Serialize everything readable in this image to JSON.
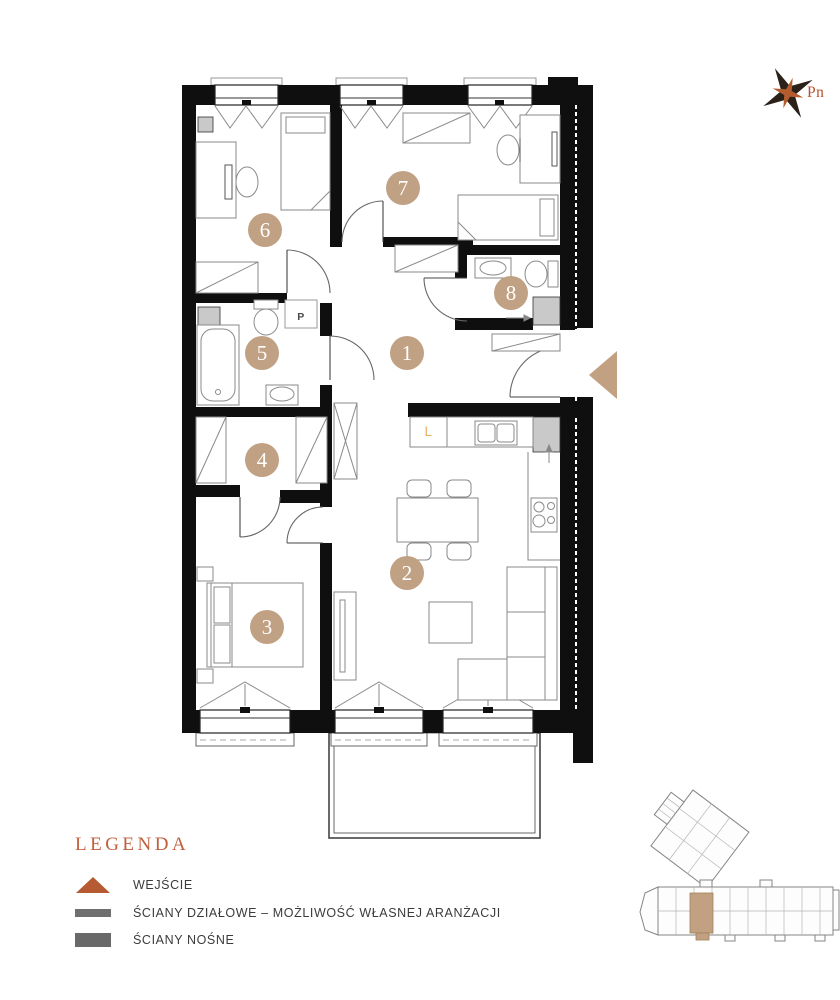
{
  "compass": {
    "north_label": "Pn"
  },
  "floor_plan": {
    "rooms": [
      {
        "number": "1"
      },
      {
        "number": "2"
      },
      {
        "number": "3"
      },
      {
        "number": "4"
      },
      {
        "number": "5"
      },
      {
        "number": "6"
      },
      {
        "number": "7"
      },
      {
        "number": "8"
      }
    ],
    "appliance_labels": {
      "washing_machine": "P",
      "fridge": "L"
    }
  },
  "legend": {
    "title": "LEGENDA",
    "items": [
      {
        "symbol": "entrance-triangle",
        "label": "WEJŚCIE"
      },
      {
        "symbol": "partition-wall-bar",
        "label": "ŚCIANY DZIAŁOWE – MOŻLIWOŚĆ WŁASNEJ ARANŻACJI"
      },
      {
        "symbol": "load-bearing-wall-bar",
        "label": "ŚCIANY NOŚNE"
      }
    ]
  },
  "colors": {
    "accent_tan": "#c1a183",
    "accent_rust": "#b5592f",
    "wall_black": "#0f0f0f",
    "legend_gray": "#6f6f6f",
    "fridge_label_orange": "#e7ae63"
  }
}
